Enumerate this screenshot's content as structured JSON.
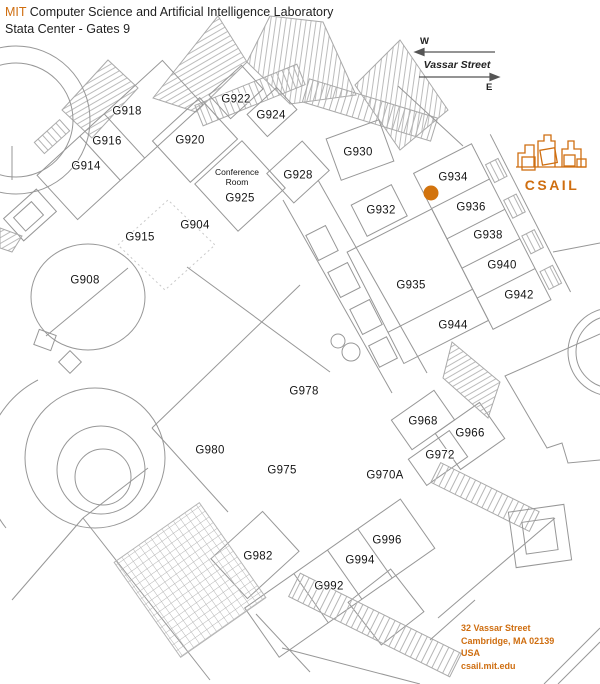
{
  "header": {
    "brand": "MIT",
    "title": "Computer Science and Artificial Intelligence Laboratory",
    "subtitle": "Stata Center - Gates 9"
  },
  "compass": {
    "west_label": "W",
    "east_label": "E",
    "street_name": "Vassar Street"
  },
  "logo": {
    "wordmark": "CSAIL"
  },
  "marker": {
    "x": 431,
    "y": 193,
    "color": "#d2730d"
  },
  "colors": {
    "accent": "#cf6e10",
    "map_line": "#979797",
    "marker": "#d2730d"
  },
  "address": {
    "lines": [
      "32 Vassar Street",
      "Cambridge, MA 02139",
      "USA",
      "csail.mit.edu"
    ]
  },
  "map": {
    "building": "Stata Center",
    "floor": "Gates 9",
    "rooms": [
      {
        "label": "G918",
        "x": 127,
        "y": 112
      },
      {
        "label": "G916",
        "x": 107,
        "y": 142
      },
      {
        "label": "G914",
        "x": 86,
        "y": 167
      },
      {
        "label": "G920",
        "x": 190,
        "y": 141
      },
      {
        "label": "G922",
        "x": 236,
        "y": 100
      },
      {
        "label": "G924",
        "x": 271,
        "y": 116
      },
      {
        "label": "Conference\nRoom",
        "x": 237,
        "y": 177,
        "small": true
      },
      {
        "label": "G925",
        "x": 240,
        "y": 199
      },
      {
        "label": "G928",
        "x": 298,
        "y": 176
      },
      {
        "label": "G930",
        "x": 358,
        "y": 153
      },
      {
        "label": "G904",
        "x": 195,
        "y": 226
      },
      {
        "label": "G915",
        "x": 140,
        "y": 238
      },
      {
        "label": "G908",
        "x": 85,
        "y": 281
      },
      {
        "label": "G932",
        "x": 381,
        "y": 211
      },
      {
        "label": "G934",
        "x": 453,
        "y": 178
      },
      {
        "label": "G936",
        "x": 471,
        "y": 208
      },
      {
        "label": "G938",
        "x": 488,
        "y": 236
      },
      {
        "label": "G940",
        "x": 502,
        "y": 266
      },
      {
        "label": "G942",
        "x": 519,
        "y": 296
      },
      {
        "label": "G935",
        "x": 411,
        "y": 286
      },
      {
        "label": "G944",
        "x": 453,
        "y": 326
      },
      {
        "label": "G978",
        "x": 304,
        "y": 392
      },
      {
        "label": "G968",
        "x": 423,
        "y": 422
      },
      {
        "label": "G966",
        "x": 470,
        "y": 434
      },
      {
        "label": "G972",
        "x": 440,
        "y": 456
      },
      {
        "label": "G980",
        "x": 210,
        "y": 451
      },
      {
        "label": "G975",
        "x": 282,
        "y": 471
      },
      {
        "label": "G970A",
        "x": 385,
        "y": 476
      },
      {
        "label": "G996",
        "x": 387,
        "y": 541
      },
      {
        "label": "G994",
        "x": 360,
        "y": 561
      },
      {
        "label": "G982",
        "x": 258,
        "y": 557
      },
      {
        "label": "G992",
        "x": 329,
        "y": 587
      }
    ]
  }
}
